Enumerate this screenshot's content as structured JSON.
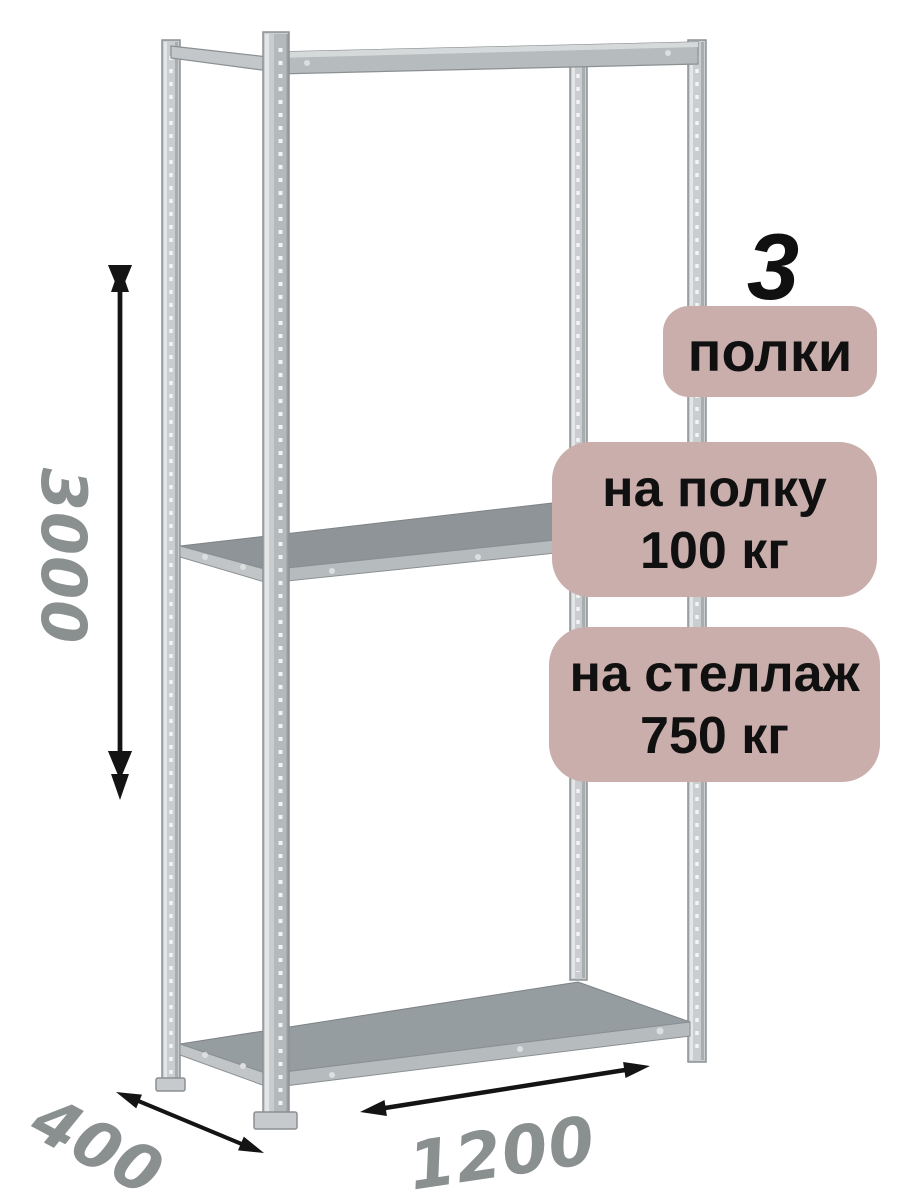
{
  "product_card": {
    "illustration": "metal-shelving-rack-render",
    "badges": {
      "count_value": "3",
      "count_label": "полки",
      "shelf_load_line1": "на полку",
      "shelf_load_line2": "100 кг",
      "rack_load_line1": "на стеллаж",
      "rack_load_line2": "750 кг"
    },
    "dimensions": {
      "height_mm": "3000",
      "depth_mm": "400",
      "width_mm": "1200"
    },
    "colors": {
      "background": "#ffffff",
      "badge_background": "#c9aeac",
      "badge_text": "#101010",
      "dimension_label": "#8a8f8f",
      "arrow": "#141414",
      "metal_light": "#c9cdcf",
      "metal_mid": "#b6bbbd",
      "metal_outline": "#8b9093",
      "shelf_surface": "#8e9497"
    }
  }
}
